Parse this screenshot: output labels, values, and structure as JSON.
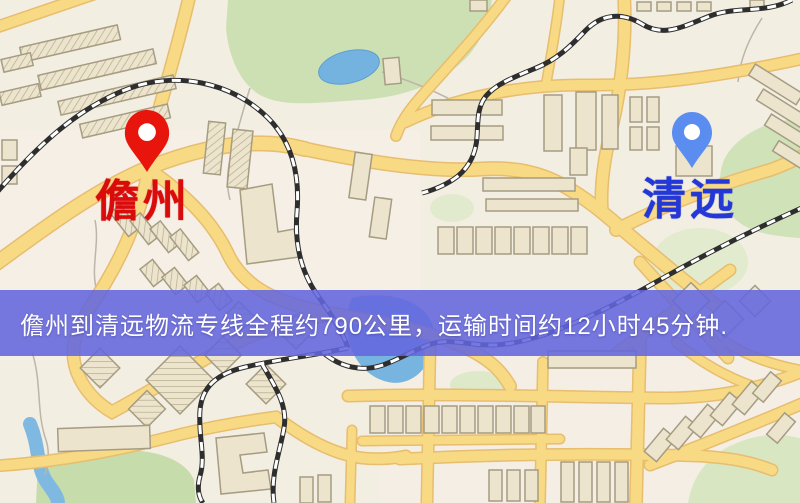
{
  "map": {
    "origin": {
      "name": "儋州",
      "label_color": "#d90b0b",
      "pin_color": "#e8150d"
    },
    "destination": {
      "name": "清远",
      "label_color": "#2438d6",
      "pin_color": "#5b8df0"
    },
    "banner": {
      "text": "儋州到清远物流专线全程约790公里，运输时间约12小时45分钟.",
      "background_color": "#6366de",
      "text_color": "#ffffff",
      "distance_text": "约790公里",
      "duration_text": "约12小时45分钟"
    },
    "palette": {
      "road": "#f8da85",
      "road_casing": "#e7bd6e",
      "water": "#78b4e0",
      "park": "#cde0b4",
      "building": "#ece4cd",
      "railway": "#333333",
      "base": "#f3eee2"
    }
  }
}
